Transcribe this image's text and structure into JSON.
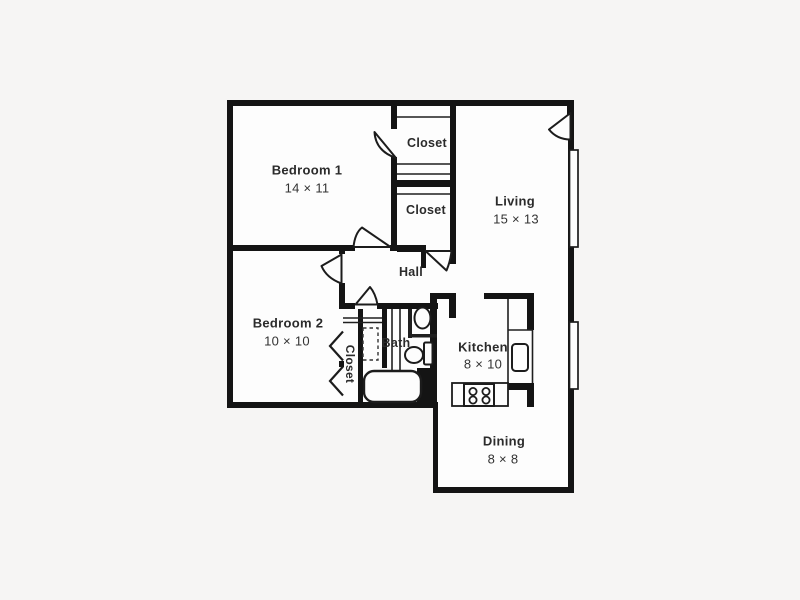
{
  "plan": {
    "title": "Apartment floor plan",
    "rooms": {
      "bedroom1": {
        "name": "Bedroom 1",
        "dims": "14 × 11"
      },
      "bedroom2": {
        "name": "Bedroom 2",
        "dims": "10 × 10"
      },
      "living": {
        "name": "Living",
        "dims": "15 × 13"
      },
      "kitchen": {
        "name": "Kitchen",
        "dims": "8 × 10"
      },
      "dining": {
        "name": "Dining",
        "dims": "8 × 8"
      },
      "hall": {
        "name": "Hall"
      },
      "bath": {
        "name": "Bath"
      },
      "closet_bedroom1": {
        "name": "Closet"
      },
      "closet_hall": {
        "name": "Closet"
      },
      "closet_bedroom2": {
        "name": "Closet"
      }
    },
    "colors": {
      "wall": "#141414",
      "line": "#1f1f1f",
      "floor": "#fdfdfd",
      "background": "#f6f5f4",
      "text": "#2b2b2b"
    }
  }
}
